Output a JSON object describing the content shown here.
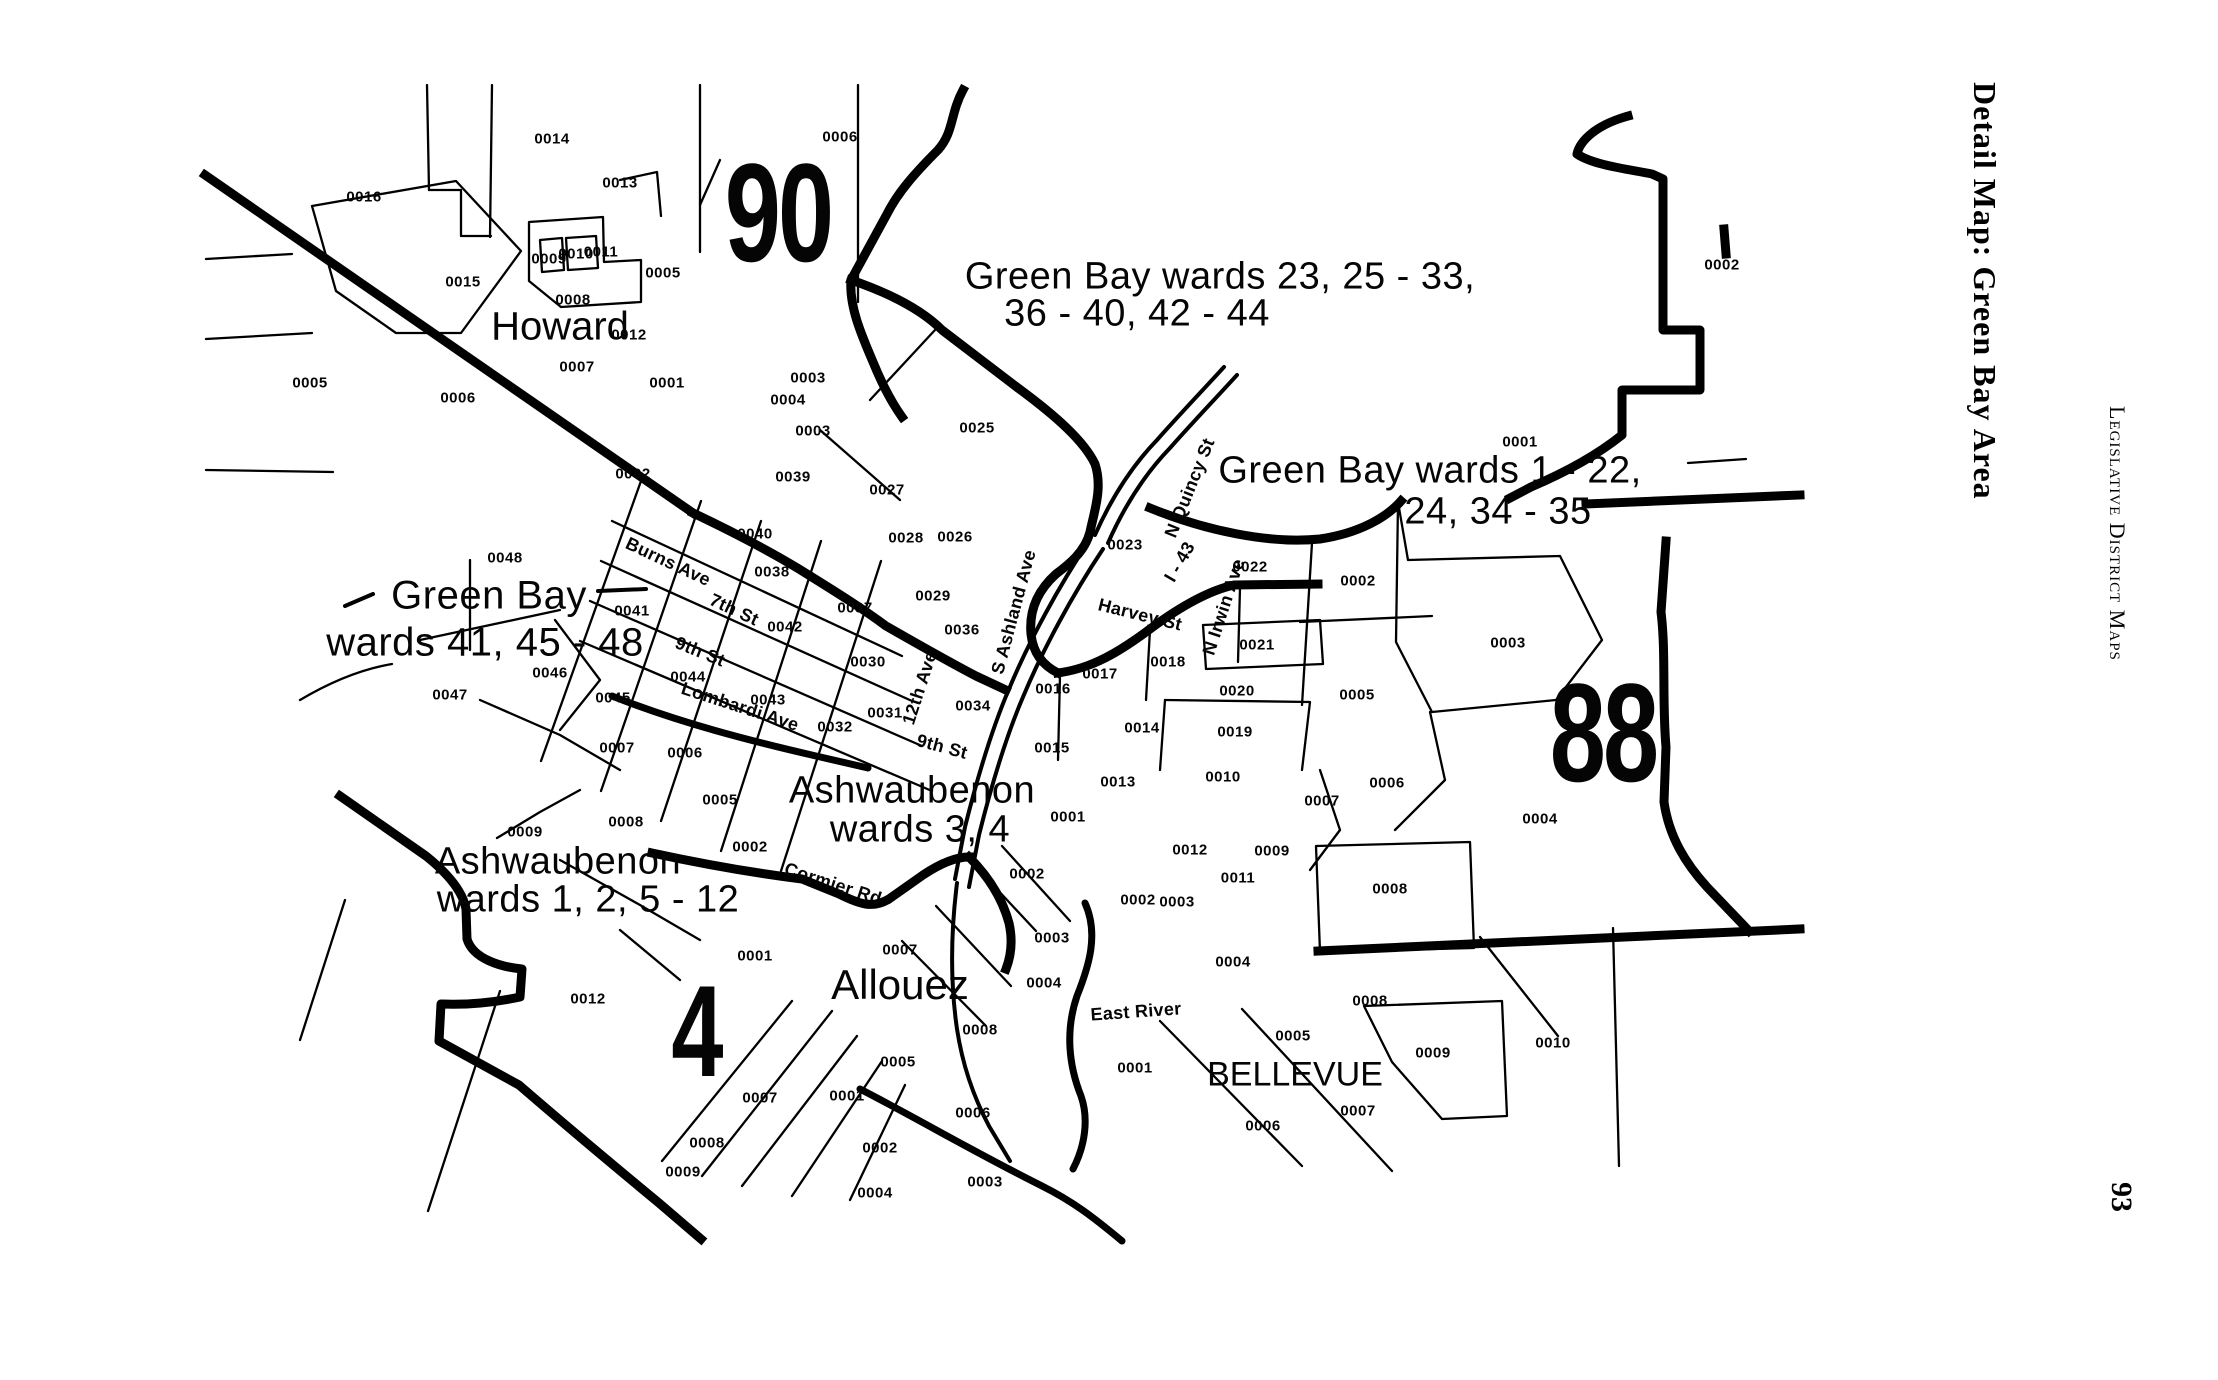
{
  "margin": {
    "detail_title": "Detail Map: Green Bay Area",
    "series_title": "Legislative District Maps",
    "page_number": "93"
  },
  "labels": {
    "districts": [
      {
        "text": "90",
        "x": 778,
        "y": 213,
        "fs": 140
      },
      {
        "text": "88",
        "x": 1603,
        "y": 733,
        "fs": 140
      },
      {
        "text": "4",
        "x": 696,
        "y": 1031,
        "fs": 130
      }
    ],
    "annotations": [
      {
        "text": "Green Bay wards 23, 25 - 33,",
        "x": 1220,
        "y": 277,
        "fs": 38
      },
      {
        "text": "36 - 40, 42 - 44",
        "x": 1137,
        "y": 314,
        "fs": 38
      },
      {
        "text": "Green Bay wards 1 - 22,",
        "x": 1430,
        "y": 471,
        "fs": 38
      },
      {
        "text": "24, 34 - 35",
        "x": 1498,
        "y": 512,
        "fs": 38
      },
      {
        "text": "Green Bay",
        "x": 489,
        "y": 596,
        "fs": 40
      },
      {
        "text": "wards 41, 45 - 48",
        "x": 485,
        "y": 643,
        "fs": 40
      },
      {
        "text": "Ashwaubenon",
        "x": 912,
        "y": 791,
        "fs": 38
      },
      {
        "text": "wards 3, 4",
        "x": 920,
        "y": 830,
        "fs": 38
      },
      {
        "text": "Ashwaubenon",
        "x": 558,
        "y": 862,
        "fs": 38
      },
      {
        "text": "wards 1, 2, 5 - 12",
        "x": 588,
        "y": 900,
        "fs": 38
      }
    ],
    "places": [
      {
        "text": "Howard",
        "x": 560,
        "y": 327,
        "fs": 40
      },
      {
        "text": "Allouez",
        "x": 900,
        "y": 985,
        "fs": 42
      },
      {
        "text": "BELLEVUE",
        "x": 1295,
        "y": 1075,
        "fs": 34
      }
    ],
    "streets": [
      {
        "text": "Burns Ave",
        "x": 668,
        "y": 562,
        "angle": 25
      },
      {
        "text": "7th St",
        "x": 734,
        "y": 610,
        "angle": 25
      },
      {
        "text": "9th St",
        "x": 700,
        "y": 652,
        "angle": 22
      },
      {
        "text": "Lombardi Ave",
        "x": 740,
        "y": 707,
        "angle": 18
      },
      {
        "text": "12th Ave",
        "x": 920,
        "y": 688,
        "angle": -72
      },
      {
        "text": "9th St",
        "x": 942,
        "y": 747,
        "angle": 15
      },
      {
        "text": "Cormier Rd",
        "x": 833,
        "y": 884,
        "angle": 18
      },
      {
        "text": "S Ashland Ave",
        "x": 1014,
        "y": 612,
        "angle": -75
      },
      {
        "text": "Harvey St",
        "x": 1140,
        "y": 615,
        "angle": 14
      },
      {
        "text": "N Quincy St",
        "x": 1190,
        "y": 488,
        "angle": -68
      },
      {
        "text": "I - 43",
        "x": 1180,
        "y": 562,
        "angle": -60
      },
      {
        "text": "N Irwin Ave",
        "x": 1224,
        "y": 607,
        "angle": -72
      },
      {
        "text": "East River",
        "x": 1136,
        "y": 1012,
        "angle": -4
      }
    ],
    "tracts": [
      {
        "text": "0014",
        "x": 552,
        "y": 139
      },
      {
        "text": "0016",
        "x": 364,
        "y": 197
      },
      {
        "text": "0013",
        "x": 620,
        "y": 183
      },
      {
        "text": "0006",
        "x": 840,
        "y": 137
      },
      {
        "text": "0002",
        "x": 1722,
        "y": 265
      },
      {
        "text": "0015",
        "x": 463,
        "y": 282
      },
      {
        "text": "0009",
        "x": 549,
        "y": 259
      },
      {
        "text": "0010",
        "x": 576,
        "y": 254
      },
      {
        "text": "0011",
        "x": 601,
        "y": 252
      },
      {
        "text": "0008",
        "x": 573,
        "y": 300
      },
      {
        "text": "0005",
        "x": 663,
        "y": 273
      },
      {
        "text": "0012",
        "x": 629,
        "y": 335
      },
      {
        "text": "0007",
        "x": 577,
        "y": 367
      },
      {
        "text": "0001",
        "x": 667,
        "y": 383
      },
      {
        "text": "0005",
        "x": 310,
        "y": 383
      },
      {
        "text": "0006",
        "x": 458,
        "y": 398
      },
      {
        "text": "0003",
        "x": 808,
        "y": 378
      },
      {
        "text": "0004",
        "x": 788,
        "y": 400
      },
      {
        "text": "0003",
        "x": 813,
        "y": 431
      },
      {
        "text": "0002",
        "x": 633,
        "y": 474
      },
      {
        "text": "0039",
        "x": 793,
        "y": 477
      },
      {
        "text": "0027",
        "x": 887,
        "y": 490
      },
      {
        "text": "0025",
        "x": 977,
        "y": 428
      },
      {
        "text": "0001",
        "x": 1520,
        "y": 442
      },
      {
        "text": "0048",
        "x": 505,
        "y": 558
      },
      {
        "text": "0040",
        "x": 755,
        "y": 534
      },
      {
        "text": "0028",
        "x": 906,
        "y": 538
      },
      {
        "text": "0026",
        "x": 955,
        "y": 537
      },
      {
        "text": "0038",
        "x": 772,
        "y": 572
      },
      {
        "text": "0023",
        "x": 1125,
        "y": 545
      },
      {
        "text": "0022",
        "x": 1250,
        "y": 567
      },
      {
        "text": "0002",
        "x": 1358,
        "y": 581
      },
      {
        "text": "0041",
        "x": 632,
        "y": 611
      },
      {
        "text": "0042",
        "x": 785,
        "y": 627
      },
      {
        "text": "0029",
        "x": 933,
        "y": 596
      },
      {
        "text": "0037",
        "x": 855,
        "y": 608
      },
      {
        "text": "0036",
        "x": 962,
        "y": 630
      },
      {
        "text": "0021",
        "x": 1257,
        "y": 645
      },
      {
        "text": "0003",
        "x": 1508,
        "y": 643
      },
      {
        "text": "0018",
        "x": 1168,
        "y": 662
      },
      {
        "text": "0030",
        "x": 868,
        "y": 662
      },
      {
        "text": "0017",
        "x": 1100,
        "y": 674
      },
      {
        "text": "0016",
        "x": 1053,
        "y": 689
      },
      {
        "text": "0020",
        "x": 1237,
        "y": 691
      },
      {
        "text": "0005",
        "x": 1357,
        "y": 695
      },
      {
        "text": "0044",
        "x": 688,
        "y": 677
      },
      {
        "text": "0046",
        "x": 550,
        "y": 673
      },
      {
        "text": "0047",
        "x": 450,
        "y": 695
      },
      {
        "text": "0045",
        "x": 613,
        "y": 698
      },
      {
        "text": "0043",
        "x": 768,
        "y": 700
      },
      {
        "text": "0034",
        "x": 973,
        "y": 706
      },
      {
        "text": "0031",
        "x": 885,
        "y": 713
      },
      {
        "text": "0032",
        "x": 835,
        "y": 727
      },
      {
        "text": "0014",
        "x": 1142,
        "y": 728
      },
      {
        "text": "0019",
        "x": 1235,
        "y": 732
      },
      {
        "text": "0015",
        "x": 1052,
        "y": 748
      },
      {
        "text": "0007",
        "x": 617,
        "y": 748
      },
      {
        "text": "0006",
        "x": 685,
        "y": 753
      },
      {
        "text": "0010",
        "x": 1223,
        "y": 777
      },
      {
        "text": "0013",
        "x": 1118,
        "y": 782
      },
      {
        "text": "0006",
        "x": 1387,
        "y": 783
      },
      {
        "text": "0005",
        "x": 720,
        "y": 800
      },
      {
        "text": "0007",
        "x": 1322,
        "y": 801
      },
      {
        "text": "0001",
        "x": 1068,
        "y": 817
      },
      {
        "text": "0004",
        "x": 1540,
        "y": 819
      },
      {
        "text": "0008",
        "x": 626,
        "y": 822
      },
      {
        "text": "0009",
        "x": 525,
        "y": 832
      },
      {
        "text": "0002",
        "x": 750,
        "y": 847
      },
      {
        "text": "0012",
        "x": 1190,
        "y": 850
      },
      {
        "text": "0009",
        "x": 1272,
        "y": 851
      },
      {
        "text": "0002",
        "x": 1027,
        "y": 874
      },
      {
        "text": "0011",
        "x": 1238,
        "y": 878
      },
      {
        "text": "0008",
        "x": 1390,
        "y": 889
      },
      {
        "text": "0002",
        "x": 1138,
        "y": 900
      },
      {
        "text": "0003",
        "x": 1177,
        "y": 902
      },
      {
        "text": "0003",
        "x": 1052,
        "y": 938
      },
      {
        "text": "0007",
        "x": 900,
        "y": 950
      },
      {
        "text": "0001",
        "x": 755,
        "y": 956
      },
      {
        "text": "0004",
        "x": 1233,
        "y": 962
      },
      {
        "text": "0004",
        "x": 1044,
        "y": 983
      },
      {
        "text": "0012",
        "x": 588,
        "y": 999
      },
      {
        "text": "0008",
        "x": 1370,
        "y": 1001
      },
      {
        "text": "0008",
        "x": 980,
        "y": 1030
      },
      {
        "text": "0005",
        "x": 1293,
        "y": 1036
      },
      {
        "text": "0010",
        "x": 1553,
        "y": 1043
      },
      {
        "text": "0009",
        "x": 1433,
        "y": 1053
      },
      {
        "text": "0005",
        "x": 898,
        "y": 1062
      },
      {
        "text": "0001",
        "x": 1135,
        "y": 1068
      },
      {
        "text": "0001",
        "x": 847,
        "y": 1096
      },
      {
        "text": "0007",
        "x": 760,
        "y": 1098
      },
      {
        "text": "0007",
        "x": 1358,
        "y": 1111
      },
      {
        "text": "0006",
        "x": 973,
        "y": 1113
      },
      {
        "text": "0006",
        "x": 1263,
        "y": 1126
      },
      {
        "text": "0008",
        "x": 707,
        "y": 1143
      },
      {
        "text": "0002",
        "x": 880,
        "y": 1148
      },
      {
        "text": "0009",
        "x": 683,
        "y": 1172
      },
      {
        "text": "0003",
        "x": 985,
        "y": 1182
      },
      {
        "text": "0004",
        "x": 875,
        "y": 1193
      }
    ]
  }
}
